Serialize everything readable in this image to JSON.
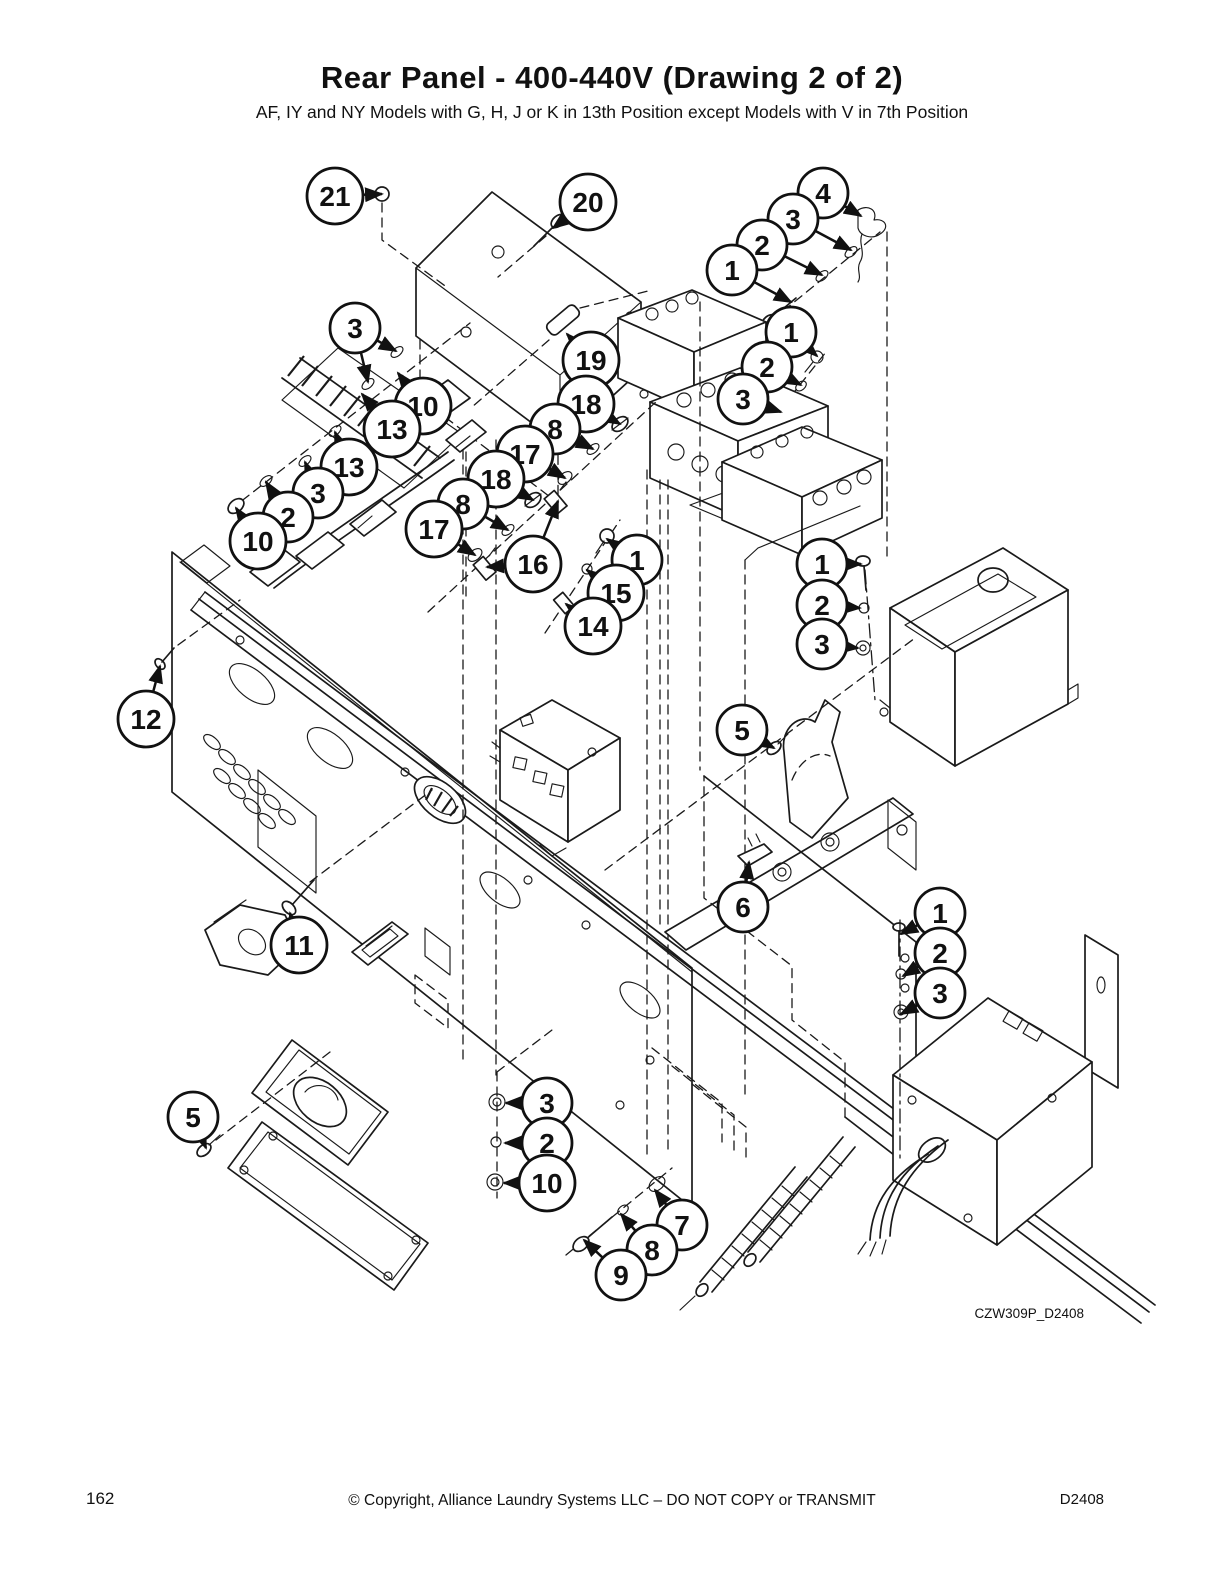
{
  "page": {
    "title": "Rear Panel - 400-440V (Drawing 2 of 2)",
    "subtitle": "AF, IY and NY Models with G, H, J or K in 13th Position except Models with V in 7th Position",
    "drawing_code": "CZW309P_D2408"
  },
  "footer": {
    "page_number": "162",
    "copyright": "© Copyright, Alliance Laundry Systems LLC – DO NOT COPY or TRANSMIT",
    "doc_code": "D2408"
  },
  "diagram": {
    "description": "Exploded parts view of rear panel assembly with numbered callout balloons",
    "callouts": [
      {
        "n": "21",
        "x": 335,
        "y": 196,
        "targets": [
          [
            382,
            194
          ]
        ]
      },
      {
        "n": "20",
        "x": 588,
        "y": 202,
        "targets": [
          [
            553,
            228
          ]
        ]
      },
      {
        "n": "19",
        "x": 591,
        "y": 360,
        "targets": [
          [
            567,
            334
          ]
        ]
      },
      {
        "n": "4",
        "x": 823,
        "y": 193,
        "targets": [
          [
            861,
            216
          ]
        ]
      },
      {
        "n": "3",
        "x": 793,
        "y": 219,
        "targets": [
          [
            851,
            250
          ]
        ]
      },
      {
        "n": "2",
        "x": 762,
        "y": 245,
        "targets": [
          [
            822,
            275
          ]
        ]
      },
      {
        "n": "1",
        "x": 732,
        "y": 270,
        "targets": [
          [
            791,
            302
          ]
        ]
      },
      {
        "n": "1",
        "x": 791,
        "y": 332,
        "targets": [
          [
            817,
            356
          ]
        ]
      },
      {
        "n": "2",
        "x": 767,
        "y": 367,
        "targets": [
          [
            801,
            385
          ]
        ]
      },
      {
        "n": "3",
        "x": 743,
        "y": 399,
        "targets": [
          [
            781,
            412
          ]
        ]
      },
      {
        "n": "3",
        "x": 355,
        "y": 328,
        "targets": [
          [
            368,
            382
          ],
          [
            396,
            351
          ]
        ]
      },
      {
        "n": "10",
        "x": 423,
        "y": 406,
        "targets": [
          [
            398,
            373
          ]
        ]
      },
      {
        "n": "13",
        "x": 392,
        "y": 429,
        "targets": [
          [
            362,
            394
          ]
        ]
      },
      {
        "n": "13",
        "x": 349,
        "y": 467,
        "targets": [
          [
            335,
            432
          ]
        ]
      },
      {
        "n": "3",
        "x": 318,
        "y": 493,
        "targets": [
          [
            305,
            462
          ]
        ]
      },
      {
        "n": "2",
        "x": 288,
        "y": 517,
        "targets": [
          [
            266,
            482
          ]
        ]
      },
      {
        "n": "10",
        "x": 258,
        "y": 541,
        "targets": [
          [
            236,
            508
          ]
        ]
      },
      {
        "n": "18",
        "x": 586,
        "y": 404,
        "targets": [
          [
            620,
            424
          ]
        ]
      },
      {
        "n": "8",
        "x": 555,
        "y": 429,
        "targets": [
          [
            593,
            449
          ]
        ]
      },
      {
        "n": "17",
        "x": 525,
        "y": 454,
        "targets": [
          [
            565,
            478
          ]
        ]
      },
      {
        "n": "18",
        "x": 496,
        "y": 479,
        "targets": [
          [
            533,
            500
          ]
        ]
      },
      {
        "n": "8",
        "x": 463,
        "y": 504,
        "targets": [
          [
            508,
            530
          ]
        ]
      },
      {
        "n": "17",
        "x": 434,
        "y": 529,
        "targets": [
          [
            475,
            555
          ]
        ]
      },
      {
        "n": "16",
        "x": 533,
        "y": 564,
        "targets": [
          [
            487,
            567
          ],
          [
            558,
            501
          ]
        ]
      },
      {
        "n": "1",
        "x": 637,
        "y": 560,
        "targets": [
          [
            607,
            539
          ]
        ]
      },
      {
        "n": "15",
        "x": 616,
        "y": 593,
        "targets": [
          [
            587,
            570
          ]
        ]
      },
      {
        "n": "14",
        "x": 593,
        "y": 626,
        "targets": [
          [
            566,
            604
          ]
        ]
      },
      {
        "n": "1",
        "x": 822,
        "y": 564,
        "targets": [
          [
            861,
            564
          ]
        ]
      },
      {
        "n": "2",
        "x": 822,
        "y": 605,
        "targets": [
          [
            860,
            608
          ]
        ]
      },
      {
        "n": "3",
        "x": 822,
        "y": 644,
        "targets": [
          [
            858,
            648
          ]
        ]
      },
      {
        "n": "12",
        "x": 146,
        "y": 719,
        "targets": [
          [
            160,
            666
          ]
        ]
      },
      {
        "n": "5",
        "x": 742,
        "y": 730,
        "targets": [
          [
            774,
            748
          ]
        ]
      },
      {
        "n": "6",
        "x": 743,
        "y": 907,
        "targets": [
          [
            749,
            862
          ]
        ]
      },
      {
        "n": "11",
        "x": 299,
        "y": 945,
        "targets": [
          [
            290,
            913
          ]
        ]
      },
      {
        "n": "1",
        "x": 940,
        "y": 913,
        "targets": [
          [
            901,
            934
          ]
        ]
      },
      {
        "n": "2",
        "x": 940,
        "y": 953,
        "targets": [
          [
            903,
            976
          ]
        ]
      },
      {
        "n": "3",
        "x": 940,
        "y": 993,
        "targets": [
          [
            901,
            1014
          ]
        ]
      },
      {
        "n": "5",
        "x": 193,
        "y": 1117,
        "targets": [
          [
            206,
            1148
          ]
        ]
      },
      {
        "n": "3",
        "x": 547,
        "y": 1103,
        "targets": [
          [
            506,
            1103
          ]
        ]
      },
      {
        "n": "2",
        "x": 547,
        "y": 1143,
        "targets": [
          [
            505,
            1143
          ]
        ]
      },
      {
        "n": "10",
        "x": 547,
        "y": 1183,
        "targets": [
          [
            504,
            1183
          ]
        ]
      },
      {
        "n": "7",
        "x": 682,
        "y": 1225,
        "targets": [
          [
            655,
            1190
          ]
        ]
      },
      {
        "n": "8",
        "x": 652,
        "y": 1250,
        "targets": [
          [
            621,
            1214
          ]
        ]
      },
      {
        "n": "9",
        "x": 621,
        "y": 1275,
        "targets": [
          [
            584,
            1240
          ]
        ]
      }
    ]
  }
}
